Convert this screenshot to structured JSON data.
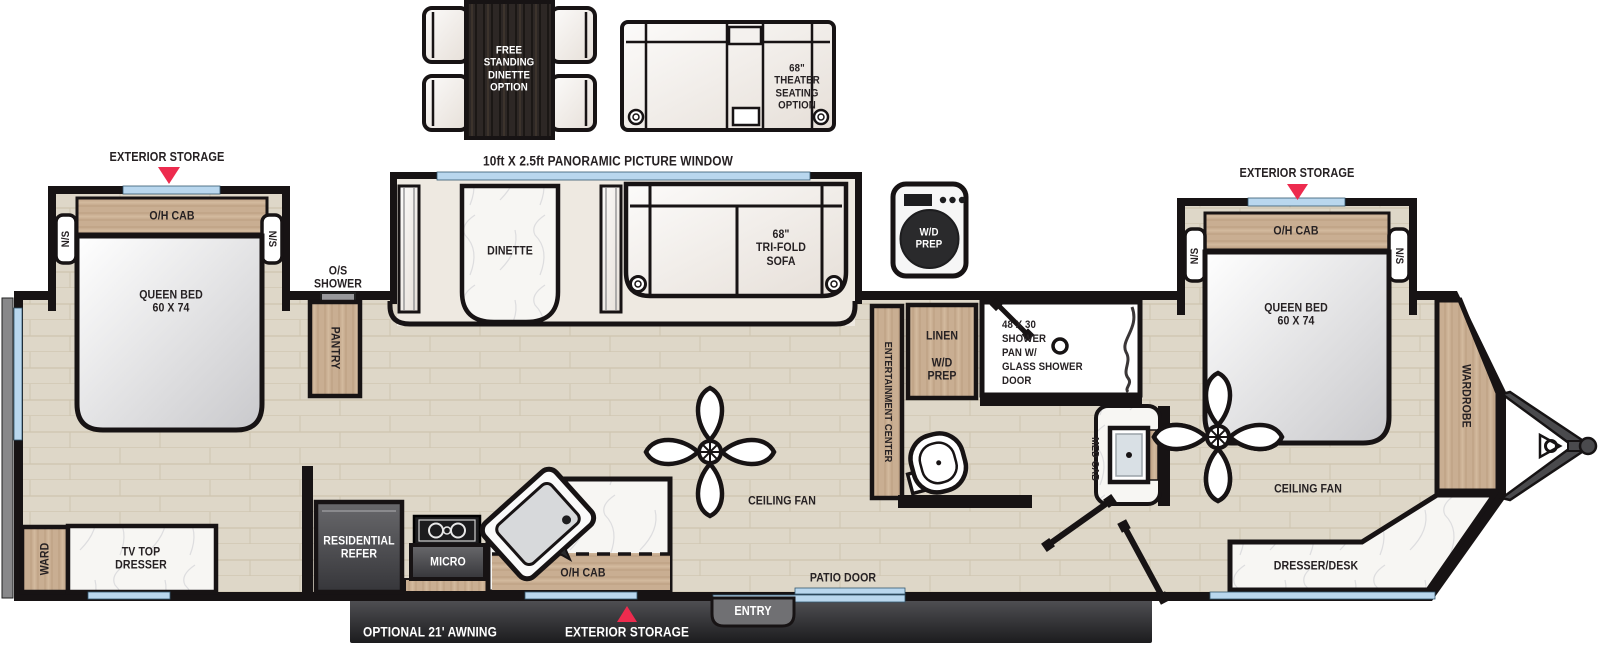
{
  "options": {
    "free_standing_dinette": "FREE\nSTANDING\nDINETTE\nOPTION",
    "theater_seating": "68\"\nTHEATER\nSEATING\nOPTION"
  },
  "exterior": {
    "panoramic_window": "10ft X 2.5ft PANORAMIC PICTURE WINDOW",
    "exterior_storage_rear": "EXTERIOR STORAGE",
    "exterior_storage_front": "EXTERIOR STORAGE",
    "exterior_storage_bottom": "EXTERIOR STORAGE",
    "optional_awning": "OPTIONAL 21' AWNING",
    "entry": "ENTRY",
    "patio_door": "PATIO DOOR"
  },
  "bedroom_rear": {
    "oh_cab": "O/H CAB",
    "ns_left": "N/S",
    "ns_right": "N/S",
    "queen_bed": "QUEEN BED\n60 X 74",
    "ward": "WARD",
    "tv_top_dresser": "TV TOP\nDRESSER"
  },
  "living": {
    "dinette": "DINETTE",
    "tri_fold_sofa": "68\"\nTRI-FOLD\nSOFA",
    "ceiling_fan": "CEILING FAN",
    "entertainment_center": "ENTERTAINMENT CENTER"
  },
  "kitchen": {
    "pantry": "PANTRY",
    "os_shower": "O/S\nSHOWER",
    "residential_refer": "RESIDENTIAL\nREFER",
    "micro": "MICRO",
    "oh_cab": "O/H CAB"
  },
  "bath": {
    "wd_prep_appliance": "W/D\nPREP",
    "linen": "LINEN",
    "wd_prep": "W/D\nPREP",
    "shower_pan": "48 X 30\nSHOWER\nPAN W/\nGLASS SHOWER\nDOOR",
    "med_cab": "MED CAB"
  },
  "bedroom_front": {
    "oh_cab": "O/H CAB",
    "ns_left": "N/S",
    "ns_right": "N/S",
    "queen_bed": "QUEEN BED\n60 X 74",
    "wardrobe": "WARDROBE",
    "dresser_desk": "DRESSER/DESK",
    "ceiling_fan": "CEILING FAN"
  },
  "colors": {
    "accent_red": "#ed2b4e",
    "window_blue": "#b9d7ee",
    "wall_black": "#171314",
    "wood_tan": "#c9ae92",
    "floor_beige": "#ded7c8"
  }
}
